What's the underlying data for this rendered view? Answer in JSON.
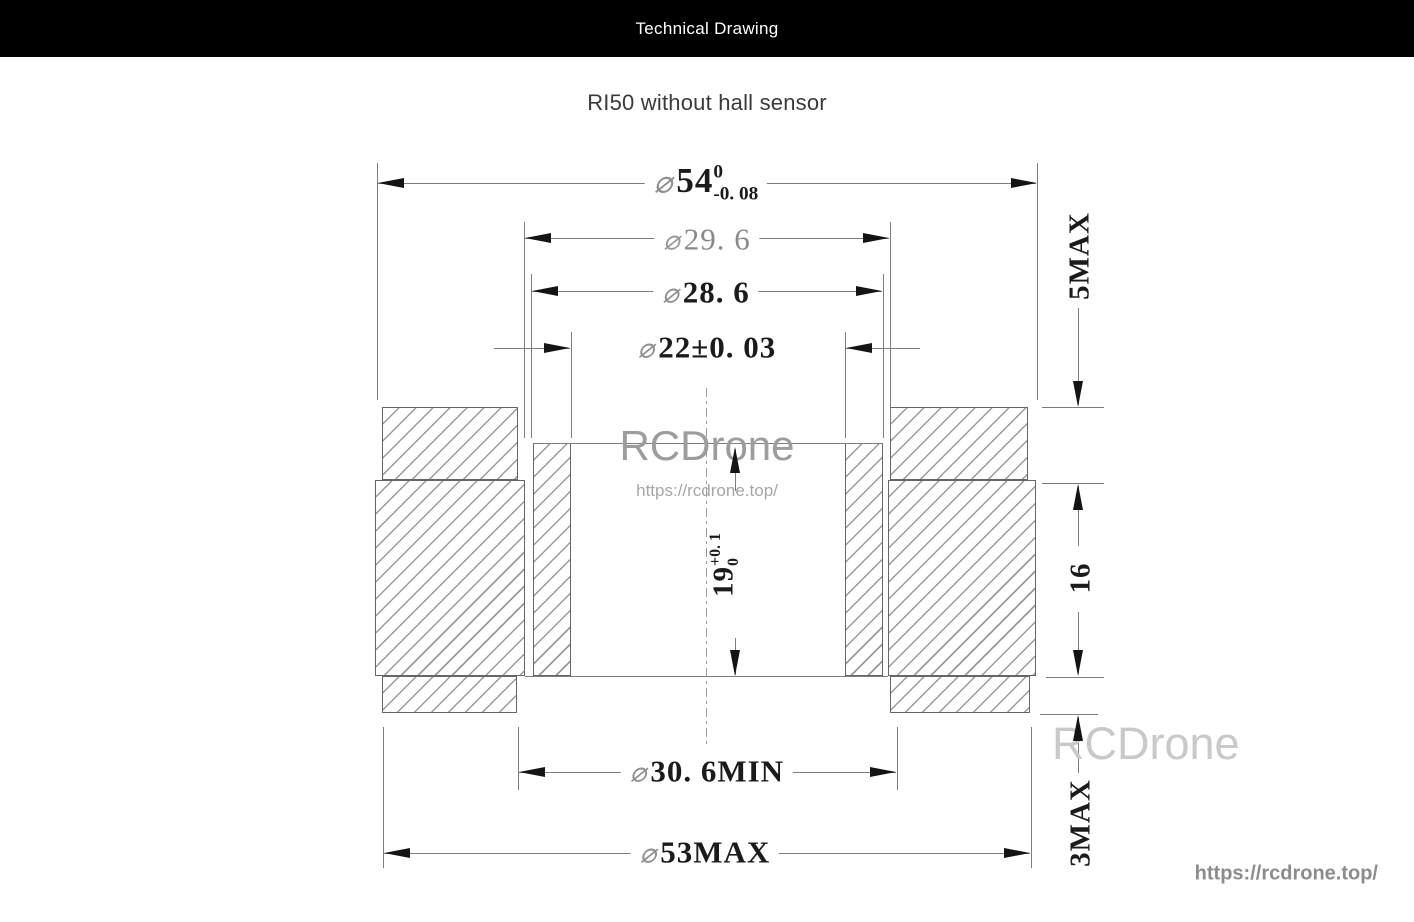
{
  "header": {
    "title": "Technical Drawing"
  },
  "page": {
    "subtitle": "RI50 without hall sensor"
  },
  "drawing": {
    "dimensions": {
      "dia54": {
        "phi": "⌀",
        "value": "54",
        "tol_upper": "0",
        "tol_lower": "-0. 08"
      },
      "dia29_6": {
        "phi": "⌀",
        "value": "29. 6"
      },
      "dia28_6": {
        "phi": "⌀",
        "value": "28. 6"
      },
      "dia22": {
        "phi": "⌀",
        "value": "22±0. 03"
      },
      "dia30_6": {
        "phi": "⌀",
        "value": "30. 6MIN"
      },
      "dia53": {
        "phi": "⌀",
        "value": "53MAX"
      },
      "height5": {
        "value": "5MAX"
      },
      "height16": {
        "value": "16"
      },
      "height19": {
        "value": "19",
        "tol_upper": "+0. 1",
        "tol_lower": "0"
      },
      "height3": {
        "value": "3MAX"
      }
    },
    "line_color": "#7d7d7d",
    "arrow_color": "#141414"
  },
  "watermarks": {
    "center_name": "RCDrone",
    "center_url": "https://rcdrone.top/",
    "corner_name": "RCDrone",
    "corner_url": "https://rcdrone.top/"
  }
}
